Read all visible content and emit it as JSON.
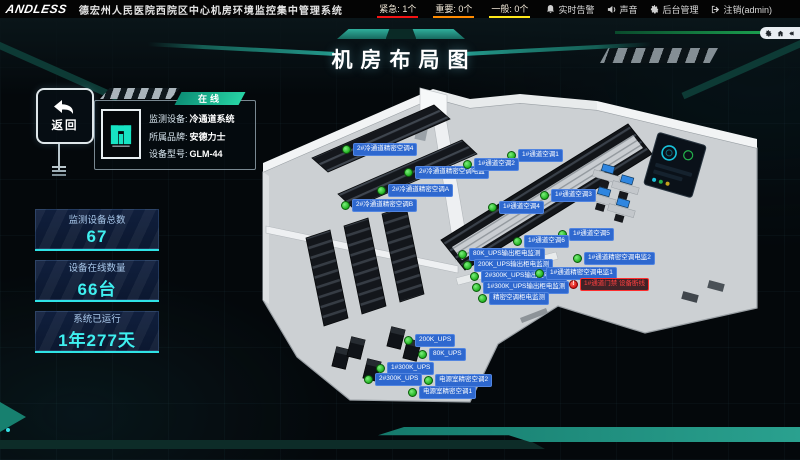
{
  "app": {
    "logo": "ANDLESS",
    "title": "德宏州人民医院西院区中心机房环境监控集中管理系统"
  },
  "topbar": {
    "alarms": [
      {
        "label": "紧急:",
        "count": "1个",
        "color": "#f31313"
      },
      {
        "label": "重要:",
        "count": "0个",
        "color": "#ff8a00"
      },
      {
        "label": "一般:",
        "count": "0个",
        "color": "#ffe81a"
      }
    ],
    "buttons": [
      {
        "label": "实时告警",
        "icon": "bell-icon"
      },
      {
        "label": "声音",
        "icon": "speaker-icon"
      },
      {
        "label": "后台管理",
        "icon": "gear-icon"
      },
      {
        "label": "注销(admin)",
        "icon": "logout-icon"
      }
    ]
  },
  "header": {
    "page_title": "机房布局图"
  },
  "device_panel": {
    "back_label": "返回",
    "status": "在线",
    "fields": [
      {
        "label": "监测设备:",
        "value": "冷通道系统"
      },
      {
        "label": "所属品牌:",
        "value": "安德力士"
      },
      {
        "label": "设备型号:",
        "value": "GLM-44"
      }
    ]
  },
  "stats": [
    {
      "label": "监测设备总数",
      "value": "67"
    },
    {
      "label": "设备在线数量",
      "value": "66台"
    },
    {
      "label": "系统已运行",
      "value": "1年277天"
    }
  ],
  "floorplan": {
    "labels": [
      {
        "text": "2#冷通道精密空调4",
        "x": 347,
        "y": 149,
        "type": "normal"
      },
      {
        "text": "2#冷通道精密空调电监",
        "x": 409,
        "y": 172,
        "type": "normal"
      },
      {
        "text": "2#冷通道精密空调A",
        "x": 382,
        "y": 190,
        "type": "normal"
      },
      {
        "text": "2#冷通道精密空调B",
        "x": 346,
        "y": 205,
        "type": "normal"
      },
      {
        "text": "1#通道空调1",
        "x": 512,
        "y": 155,
        "type": "normal"
      },
      {
        "text": "1#通道空调2",
        "x": 468,
        "y": 164,
        "type": "normal"
      },
      {
        "text": "1#通道空调3",
        "x": 545,
        "y": 195,
        "type": "normal"
      },
      {
        "text": "1#通道空调4",
        "x": 493,
        "y": 207,
        "type": "normal"
      },
      {
        "text": "1#通道空调5",
        "x": 563,
        "y": 234,
        "type": "normal"
      },
      {
        "text": "1#通道空调6",
        "x": 518,
        "y": 241,
        "type": "normal"
      },
      {
        "text": "80K_UPS输出柜电监测",
        "x": 463,
        "y": 254,
        "type": "normal"
      },
      {
        "text": "200K_UPS输出柜电监测",
        "x": 468,
        "y": 265,
        "type": "normal"
      },
      {
        "text": "2#300K_UPS输出柜电监测",
        "x": 475,
        "y": 276,
        "type": "normal"
      },
      {
        "text": "1#300K_UPS输出柜电监测",
        "x": 477,
        "y": 287,
        "type": "normal"
      },
      {
        "text": "精密空调柜电监测",
        "x": 483,
        "y": 298,
        "type": "normal"
      },
      {
        "text": "1#通道精密空调电监2",
        "x": 578,
        "y": 258,
        "type": "normal"
      },
      {
        "text": "1#通道精密空调电监1",
        "x": 540,
        "y": 273,
        "type": "normal"
      },
      {
        "text": "1#通道门禁 设备断线",
        "x": 574,
        "y": 284,
        "type": "alarm"
      },
      {
        "text": "200K_UPS",
        "x": 409,
        "y": 340,
        "type": "normal"
      },
      {
        "text": "80K_UPS",
        "x": 423,
        "y": 354,
        "type": "normal"
      },
      {
        "text": "1#300K_UPS",
        "x": 381,
        "y": 368,
        "type": "normal"
      },
      {
        "text": "2#300K_UPS",
        "x": 369,
        "y": 379,
        "type": "normal"
      },
      {
        "text": "电源室精密空调2",
        "x": 429,
        "y": 380,
        "type": "normal"
      },
      {
        "text": "电源室精密空调1",
        "x": 413,
        "y": 392,
        "type": "normal"
      }
    ]
  },
  "colors": {
    "accent_teal": "#23978a",
    "cyan_value": "#3ff0f0",
    "label_blue": "#2e68cf",
    "dot_green": "#21b321",
    "alarm_red": "#f31313",
    "online_green": "#27d3a4"
  }
}
